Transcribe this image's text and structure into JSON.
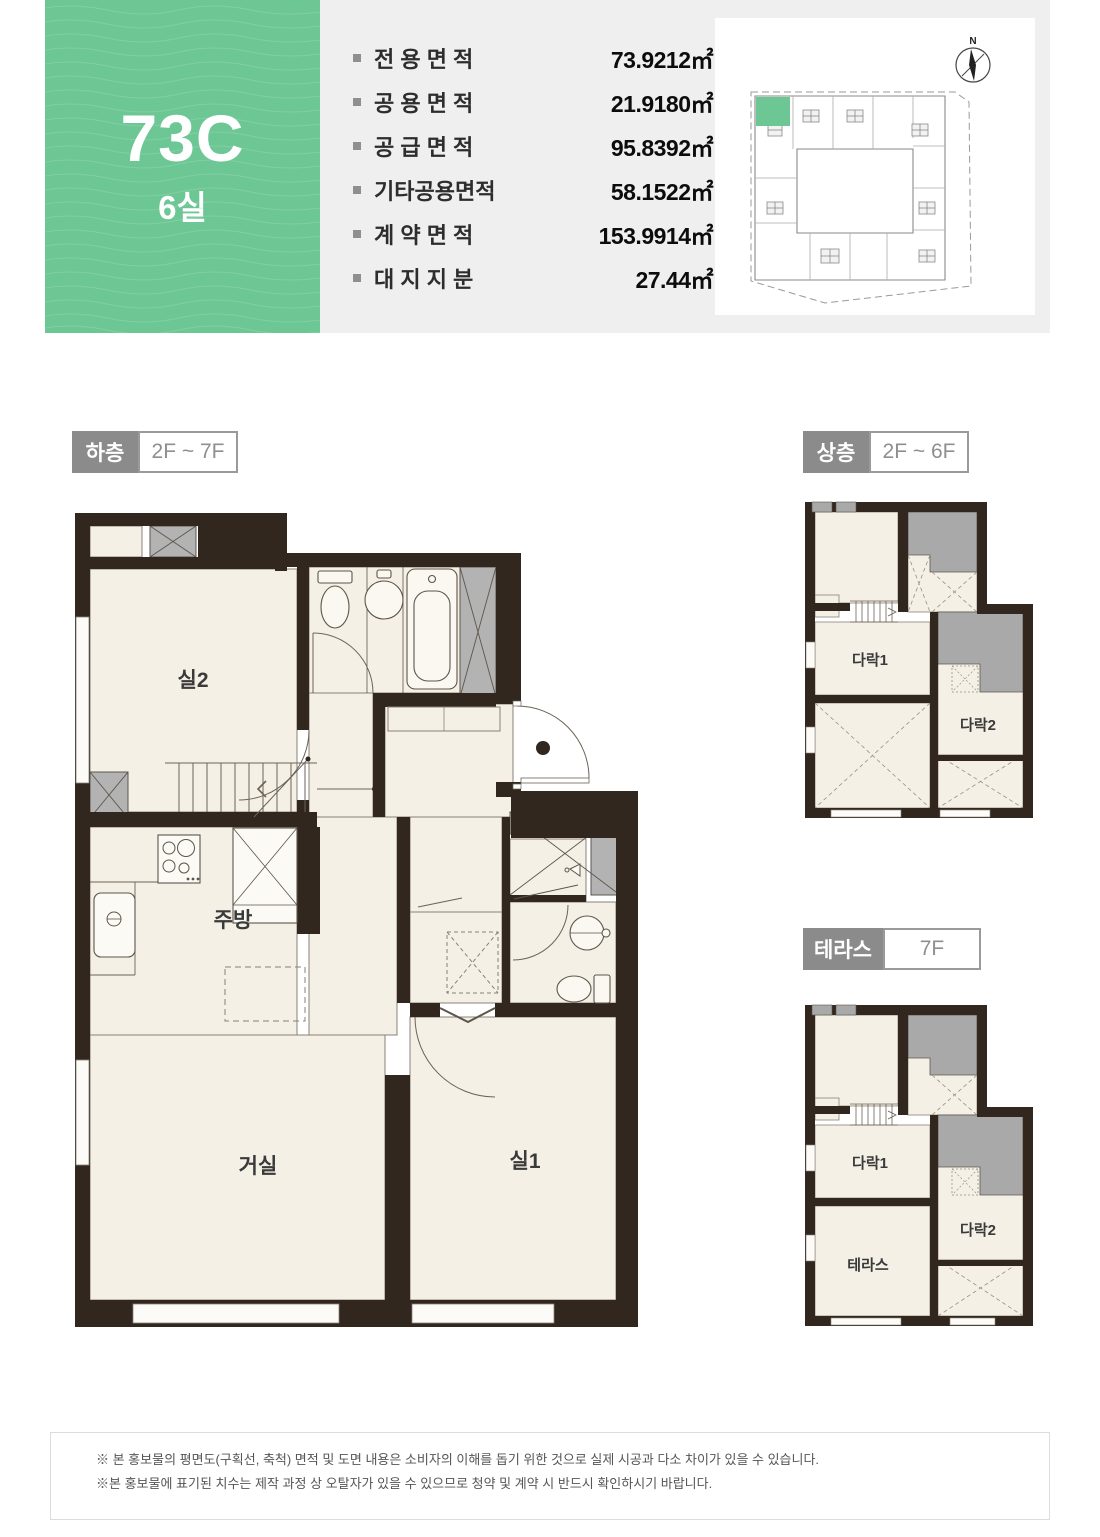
{
  "unit": {
    "code": "73C",
    "rooms": "6실"
  },
  "specs": {
    "rows": [
      {
        "label": "전 용 면 적",
        "value": "73.9212㎡"
      },
      {
        "label": "공 용 면 적",
        "value": "21.9180㎡"
      },
      {
        "label": "공 급 면 적",
        "value": "95.8392㎡"
      },
      {
        "label": "기타공용면적",
        "value": "58.1522㎡"
      },
      {
        "label": "계 약 면 적",
        "value": "153.9914㎡"
      },
      {
        "label": "대 지 지 분",
        "value": "27.44㎡"
      }
    ]
  },
  "site_plan": {
    "compass_label": "N"
  },
  "plans": {
    "lower": {
      "badge": "하층",
      "floors": "2F ~ 7F",
      "rooms": {
        "room2": "실2",
        "kitchen": "주방",
        "living": "거실",
        "room1": "실1"
      }
    },
    "upper": {
      "badge": "상층",
      "floors": "2F ~ 6F",
      "rooms": {
        "attic1": "다락1",
        "attic2": "다락2"
      }
    },
    "terrace": {
      "badge": "테라스",
      "floors": "7F",
      "rooms": {
        "attic1": "다락1",
        "attic2": "다락2",
        "terrace": "테라스"
      }
    }
  },
  "footer": {
    "line1": "※ 본 홍보물의 평면도(구획선, 축척) 면적 및 도면 내용은 소비자의 이해를 돕기 위한 것으로 실제 시공과 다소 차이가 있을 수 있습니다.",
    "line2": "※본 홍보물에 표기된 치수는 제작 과정 상 오탈자가 있을 수 있으므로 청약 및 계약 시 반드시 확인하시기 바랍니다."
  },
  "colors": {
    "accent_green": "#6cc794",
    "panel_gray": "#efefef",
    "badge_gray": "#8b8b8b",
    "wall_dark": "#31271f",
    "floor_cream": "#f4f0e5",
    "void_gray": "#a9a9a9"
  }
}
